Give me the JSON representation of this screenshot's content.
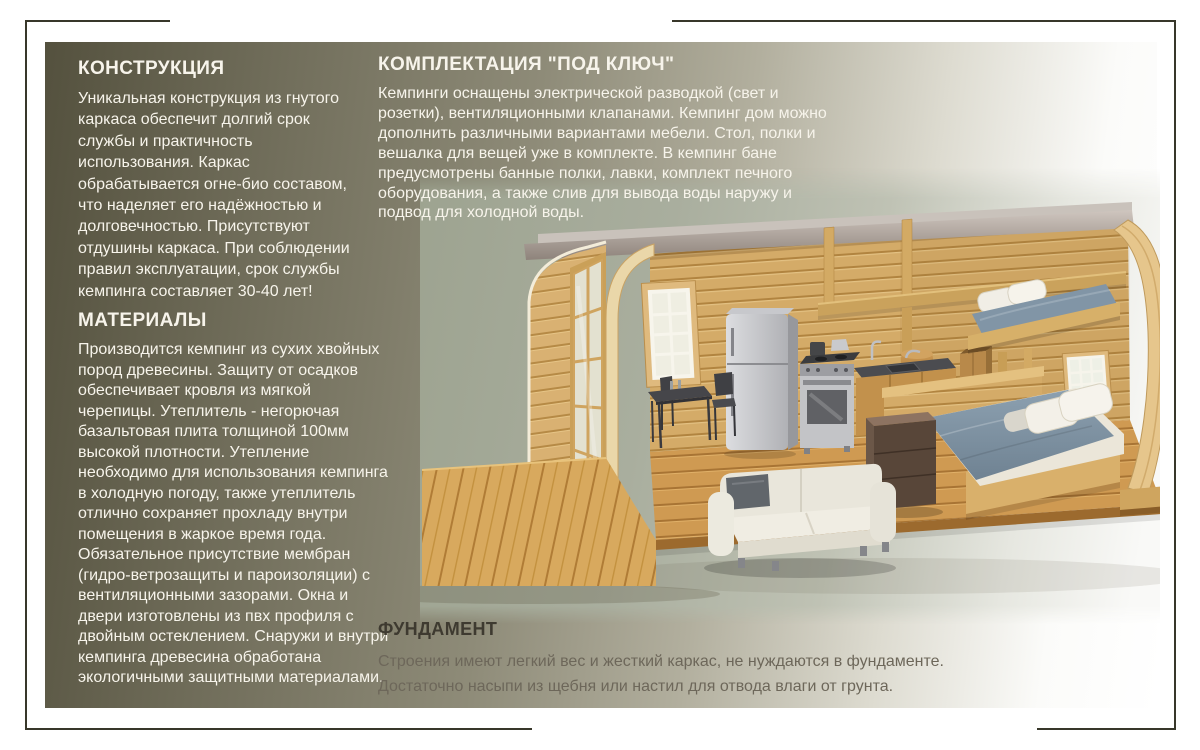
{
  "page": {
    "frame_color": "#38372a",
    "panel_colors": {
      "left_dark": "#54513e",
      "mid_olive": "#8e8b78",
      "right_light": "#ffffff"
    },
    "photo_backdrop_color": "#a9ae9e"
  },
  "sections": {
    "construction": {
      "heading": "КОНСТРУКЦИЯ",
      "body": "Уникальная конструкция из гнутого\nкаркаса обеспечит долгий срок\nслужбы и практичность\nиспользования. Каркас\nобрабатывается огне-био составом,\nчто наделяет его надёжностью и\nдолговечностью. Присутствуют\nотдушины каркаса. При соблюдении\nправил эксплуатации, срок службы\nкемпинга составляет 30-40 лет!"
    },
    "materials": {
      "heading": "МАТЕРИАЛЫ",
      "body": "Производится кемпинг из сухих хвойных\nпород древесины. Защиту от осадков\nобеспечивает кровля из мягкой\nчерепицы.  Утеплитель - негорючая\nбазальтовая плита толщиной 100мм\nвысокой плотности. Утепление\nнеобходимо для использования кемпинга\nв холодную погоду, также утеплитель\nотлично сохраняет прохладу внутри\nпомещения в жаркое время года.\nОбязательное присутствие мембран\n(гидро-ветрозащиты и пароизоляции) с\nвентиляционными зазорами. Окна и\nдвери изготовлены из пвх профиля с\nдвойным остеклением. Снаружи и внутри\nкемпинга древесина обработана\nэкологичными  защитными материалами."
    },
    "equipment": {
      "heading": "КОМПЛЕКТАЦИЯ \"ПОД КЛЮЧ\"",
      "body": "Кемпинги оснащены электрической разводкой (свет и\nрозетки), вентиляционными клапанами. Кемпинг дом можно\nдополнить различными вариантами мебели. Стол, полки и\nвешалка для вещей уже в комплекте. В кемпинг бане\nпредусмотрены банные полки, лавки, комплект печного\nоборудования, а также слив для вывода воды наружу и\nподвод для холодной воды."
    },
    "foundation": {
      "heading": "ФУНДАМЕНТ",
      "body": "Строения имеют легкий вес и жесткий каркас, не нуждаются в фундаменте.\nДостаточно насыпи из щебня или настил для отвода влаги от грунта."
    }
  },
  "illustration": {
    "label": "3D cutaway of barrel-roof wooden camping house with kitchen, sofa, double bed and loft bed",
    "wood_color": "#d4ab68",
    "mattress_color": "#8195a6",
    "sofa_color": "#eceadf",
    "fridge_color": "#c7c8cc"
  }
}
